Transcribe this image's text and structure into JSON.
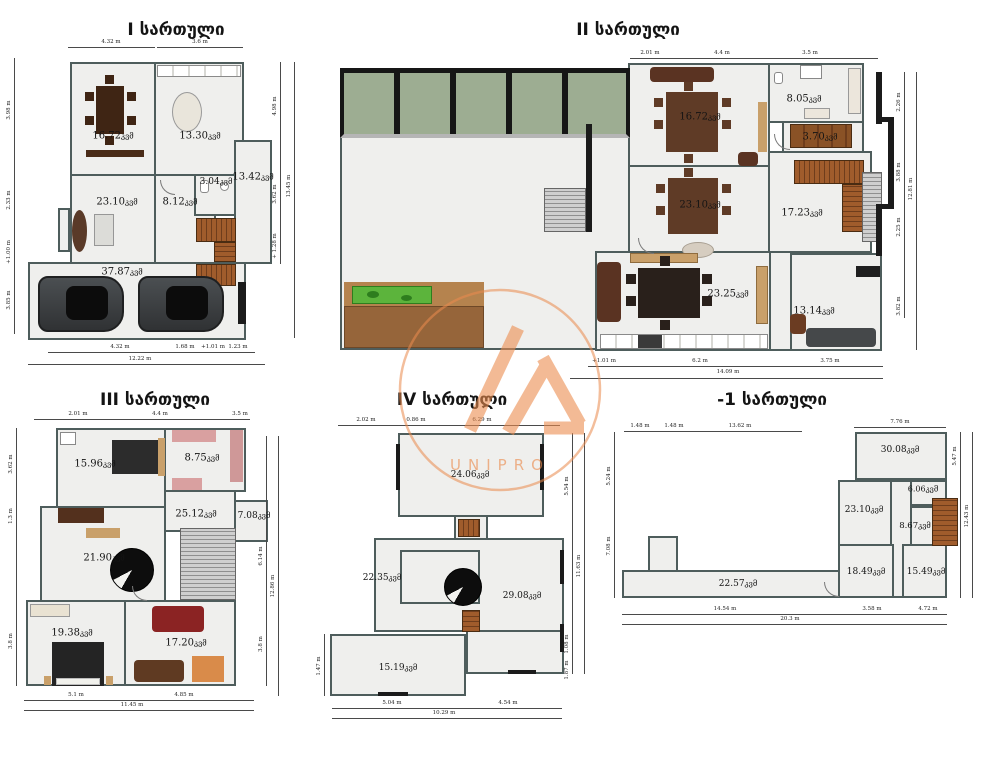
{
  "unit": "კვმ",
  "watermark": {
    "brand": "UNIPRO",
    "accent": "#E98A4E"
  },
  "palette": {
    "wall": "#4E5D5C",
    "floor_fill": "#EFEFED",
    "window_glass": "#9DAD92",
    "deck_dark": "#96653A",
    "deck_light": "#B5834E",
    "lawn": "#5CB43C"
  },
  "floors": [
    {
      "id": "1",
      "title": "I სართული",
      "rooms": [
        {
          "name": "dining-room",
          "area": "16.72"
        },
        {
          "name": "kitchen",
          "area": "13.30"
        },
        {
          "name": "living-room",
          "area": "23.10"
        },
        {
          "name": "hallway",
          "area": "8.12"
        },
        {
          "name": "bathroom",
          "area": "3.04"
        },
        {
          "name": "side-room",
          "area": "13.42"
        },
        {
          "name": "garage",
          "area": "37.87"
        }
      ],
      "dims": {
        "top": [
          "4.32 m",
          "3.6 m"
        ],
        "right": [
          "4.98 m",
          "3.62 m",
          "+ 1.28 m",
          "13.45 m"
        ],
        "bottom": [
          "4.32 m",
          "1.68 m",
          "+1.01 m",
          "1.23 m",
          "12.22 m"
        ],
        "left": [
          "3.98 m",
          "2.33 m",
          "+1.00 m",
          "3.85 m"
        ]
      }
    },
    {
      "id": "2",
      "title": "II სართული",
      "rooms": [
        {
          "name": "living-room",
          "area": "16.72"
        },
        {
          "name": "bathroom",
          "area": "8.05"
        },
        {
          "name": "closet",
          "area": "3.70"
        },
        {
          "name": "dining-room",
          "area": "23.10"
        },
        {
          "name": "stair-hall",
          "area": "17.23"
        },
        {
          "name": "kitchen-dining",
          "area": "23.25"
        },
        {
          "name": "lounge",
          "area": "13.14"
        }
      ],
      "dims": {
        "top": [
          "2.01 m",
          "4.4 m",
          "3.5 m"
        ],
        "right": [
          "2.26 m",
          "3.88 m",
          "2.25 m",
          "3.82 m",
          "12.81 m"
        ],
        "bottom": [
          "+1.01 m",
          "6.2 m",
          "3.75 m",
          "14.09 m"
        ],
        "left": []
      }
    },
    {
      "id": "3",
      "title": "III სართული",
      "rooms": [
        {
          "name": "bedroom",
          "area": "15.96"
        },
        {
          "name": "wardrobe",
          "area": "8.75"
        },
        {
          "name": "hall",
          "area": "25.12"
        },
        {
          "name": "bathroom",
          "area": "7.08"
        },
        {
          "name": "family-room",
          "area": "21.90"
        },
        {
          "name": "bedroom-2",
          "area": "19.38"
        },
        {
          "name": "living-room",
          "area": "17.20"
        }
      ],
      "dims": {
        "top": [
          "2.01 m",
          "4.4 m",
          "3.5 m"
        ],
        "right": [
          "6.14 m",
          "3.8 m",
          "12.86 m"
        ],
        "bottom": [
          "5.1 m",
          "4.85 m",
          "11.45 m"
        ],
        "left": [
          "3.62 m",
          "1.3 m",
          "3.8 m"
        ]
      }
    },
    {
      "id": "4",
      "title": "IV სართული",
      "rooms": [
        {
          "name": "attic-room",
          "area": "24.06"
        },
        {
          "name": "hall",
          "area": "22.35"
        },
        {
          "name": "studio",
          "area": "29.08"
        },
        {
          "name": "room",
          "area": "15.19"
        }
      ],
      "dims": {
        "top": [
          "2.02 m",
          "0.86 m",
          "6.29 m"
        ],
        "right": [
          "5.54 m",
          "11.63 m",
          "1.08 m",
          "1.87 m"
        ],
        "bottom": [
          "5.04 m",
          "4.54 m",
          "10.29 m"
        ],
        "left": [
          "1.47 m"
        ]
      }
    },
    {
      "id": "-1",
      "title": "-1 სართული",
      "rooms": [
        {
          "name": "storage",
          "area": "30.08"
        },
        {
          "name": "closet",
          "area": "6.06"
        },
        {
          "name": "room",
          "area": "23.10"
        },
        {
          "name": "stair-hall",
          "area": "8.67"
        },
        {
          "name": "room-2",
          "area": "18.49"
        },
        {
          "name": "room-3",
          "area": "15.49"
        },
        {
          "name": "corridor",
          "area": "22.57"
        }
      ],
      "dims": {
        "top": [
          "1.48 m",
          "1.48 m",
          "13.62 m",
          "7.76 m"
        ],
        "right": [
          "5.47 m",
          "12.43 m"
        ],
        "bottom": [
          "14.54 m",
          "3.58 m",
          "4.72 m",
          "20.3 m"
        ],
        "left": [
          "5.24 m",
          "7.08 m"
        ]
      }
    }
  ]
}
